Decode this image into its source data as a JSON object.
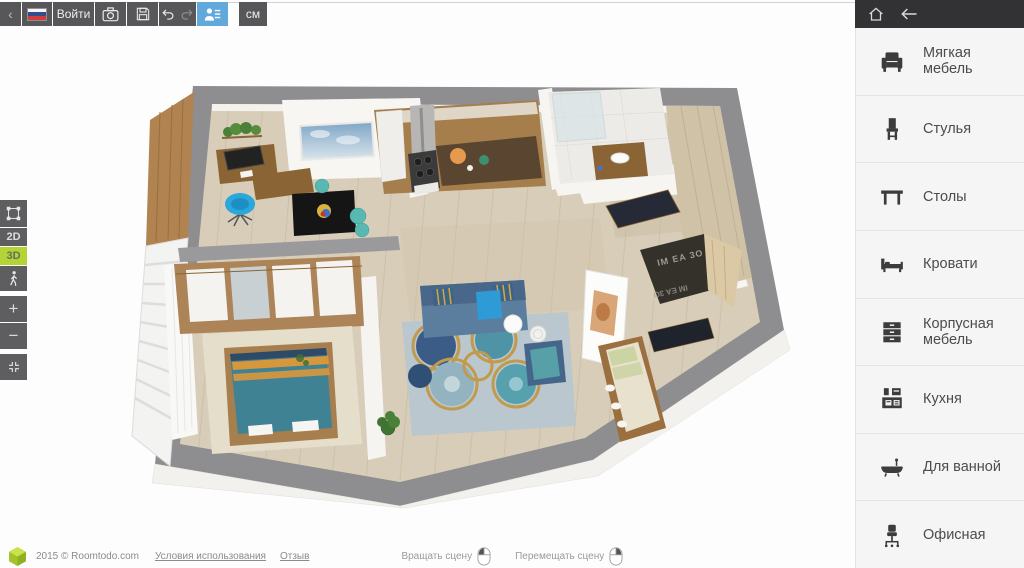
{
  "topbar": {
    "collapse": "‹",
    "login": "Войти",
    "units": "см"
  },
  "left_tools": {
    "mode_2d": "2D",
    "mode_3d": "3D",
    "zoom_in": "+",
    "zoom_out": "−"
  },
  "sidebar": {
    "items": [
      {
        "label": "Мягкая мебель",
        "icon": "armchair-icon"
      },
      {
        "label": "Стулья",
        "icon": "chair-icon"
      },
      {
        "label": "Столы",
        "icon": "table-icon"
      },
      {
        "label": "Кровати",
        "icon": "bed-icon"
      },
      {
        "label": "Корпусная мебель",
        "icon": "cabinet-icon"
      },
      {
        "label": "Кухня",
        "icon": "kitchen-icon"
      },
      {
        "label": "Для ванной",
        "icon": "bathtub-icon"
      },
      {
        "label": "Офисная",
        "icon": "office-chair-icon"
      }
    ]
  },
  "footer": {
    "copyright": "2015 © Roomtodo.com",
    "terms": "Условия использования",
    "feedback": "Отзыв",
    "rotate_hint": "Вращать сцену",
    "pan_hint": "Перемещать сцену"
  },
  "scene": {
    "rug_text": "IM EA 3O"
  },
  "colors": {
    "toolbar_bg": "#57575a",
    "accent_blue": "#61a9da",
    "active_green": "#b3d435",
    "sidebar_bg": "#f5f5f5"
  }
}
